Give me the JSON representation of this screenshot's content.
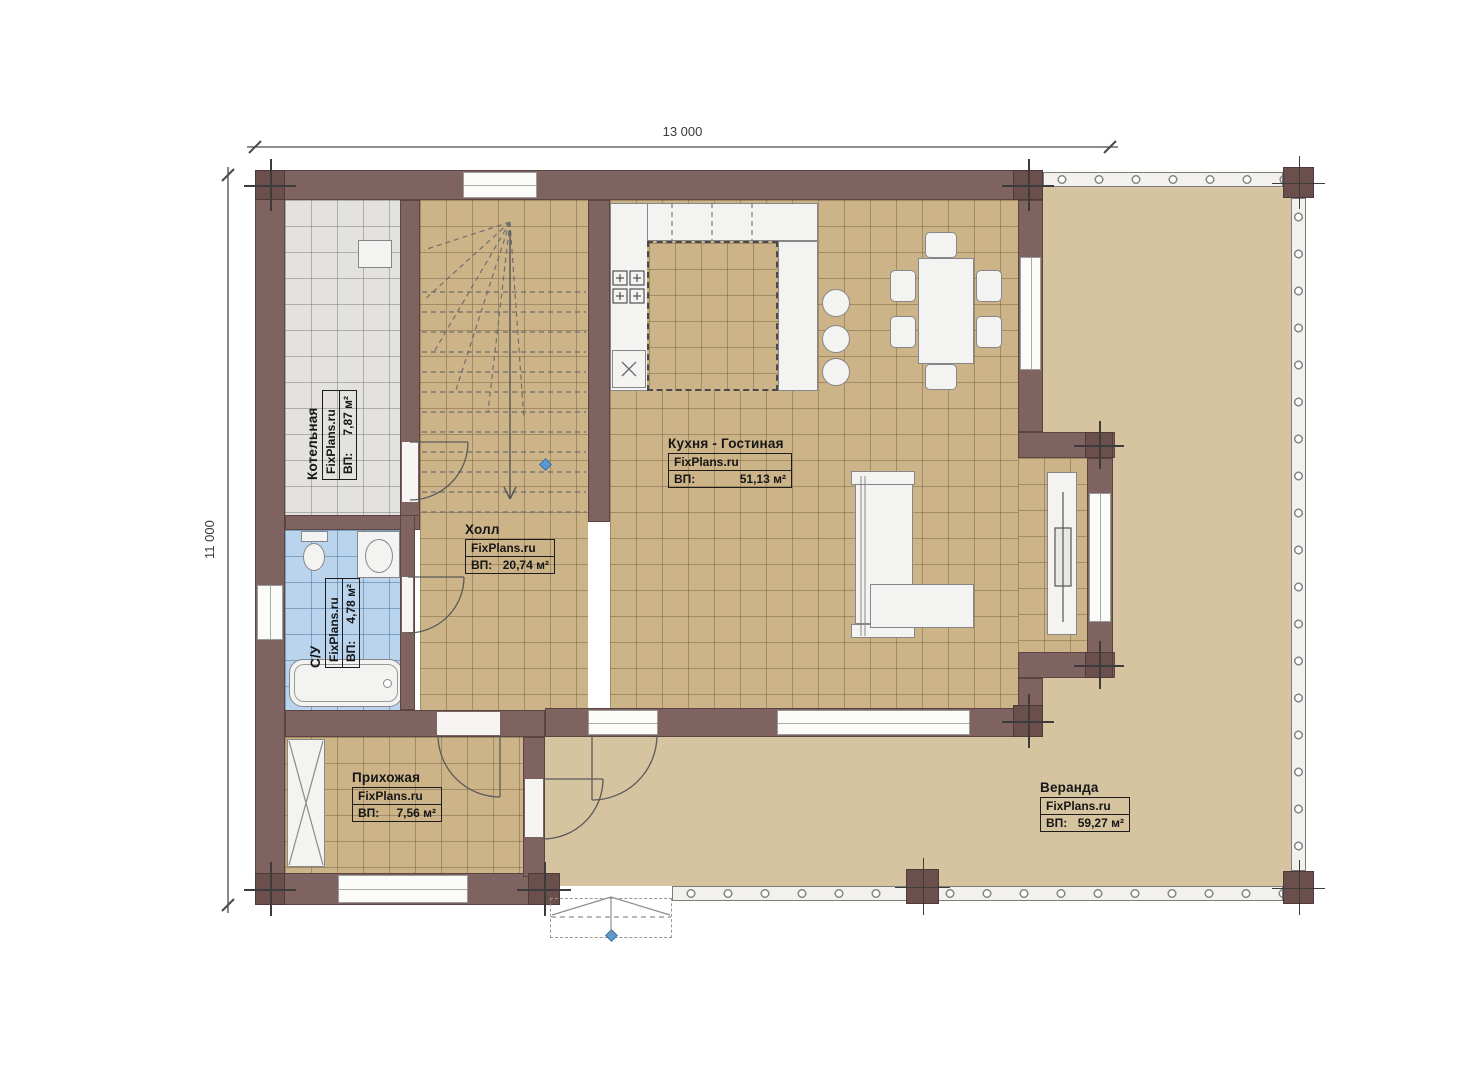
{
  "dimensions": {
    "width_label": "13 000",
    "height_label": "11 000"
  },
  "watermark": "FixPlans.ru",
  "rooms": {
    "kotelnaya": {
      "name": "Котельная",
      "source": "FixPlans.ru",
      "area_label": "ВП:",
      "area_value": "7,87 м²"
    },
    "su": {
      "name": "С/У",
      "source": "FixPlans.ru",
      "area_label": "ВП:",
      "area_value": "4,78 м²"
    },
    "hall": {
      "name": "Холл",
      "source": "FixPlans.ru",
      "area_label": "ВП:",
      "area_value": "20,74 м²"
    },
    "kitchen": {
      "name": "Кухня - Гостиная",
      "source": "FixPlans.ru",
      "area_label": "ВП:",
      "area_value": "51,13 м²"
    },
    "hallway": {
      "name": "Прихожая",
      "source": "FixPlans.ru",
      "area_label": "ВП:",
      "area_value": "7,56 м²"
    },
    "veranda": {
      "name": "Веранда",
      "source": "FixPlans.ru",
      "area_label": "ВП:",
      "area_value": "59,27 м²"
    }
  },
  "colors": {
    "wall": "#7e6360",
    "column": "#6a4f4c",
    "floor_tile": "#ccb388",
    "veranda_floor": "#d6c3a0",
    "boiler_tile": "#e3e2de",
    "bath_tile": "#b9d4ec",
    "accent_marker": "#5b9bd5"
  }
}
